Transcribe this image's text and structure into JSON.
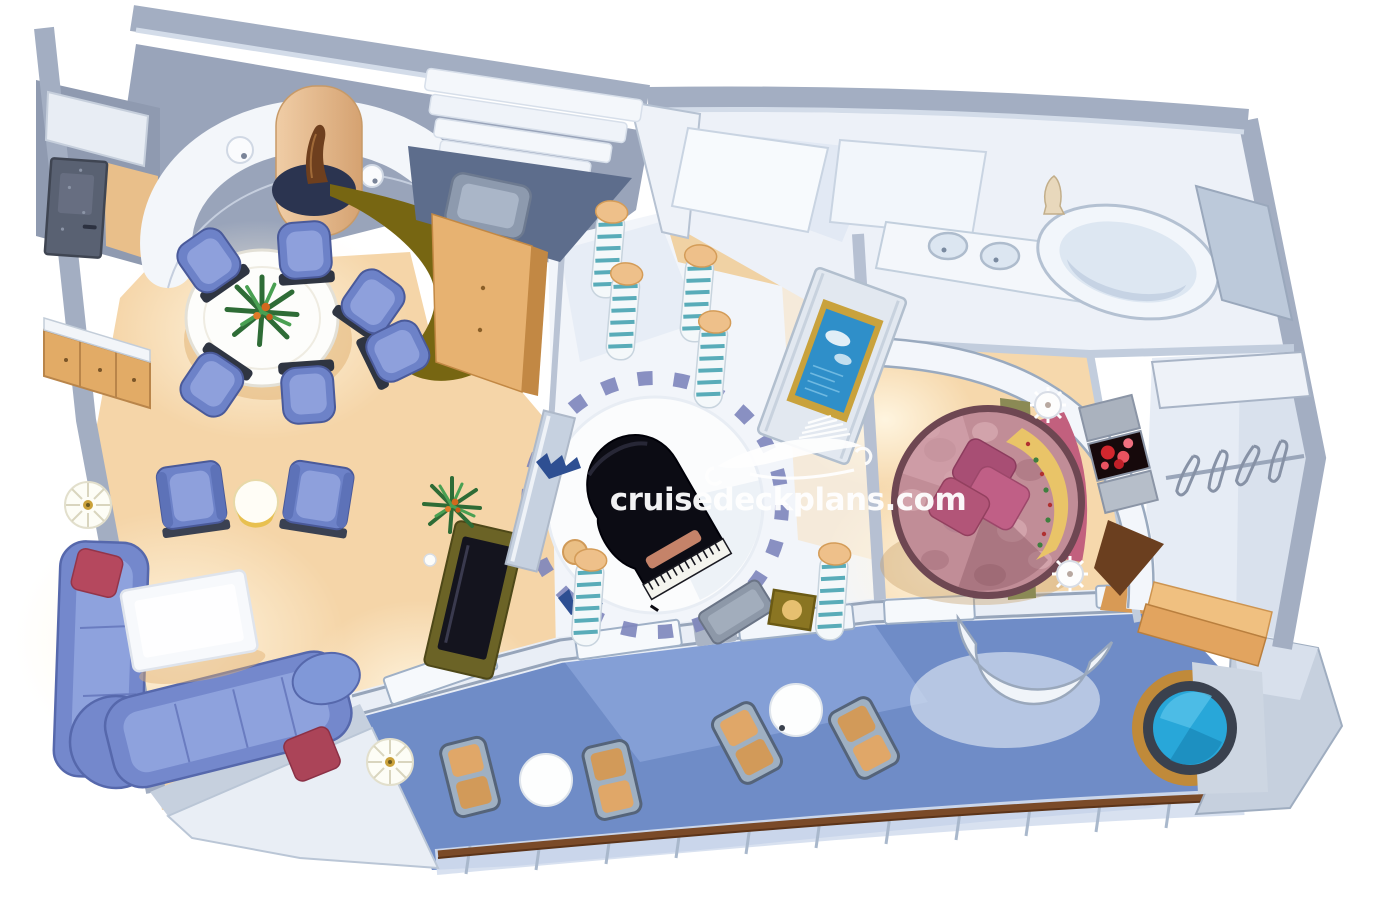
{
  "meta": {
    "kind": "cruise-ship-suite-cutaway-floorplan-rendering",
    "description": "Isometric artist rendering of a luxury cruise ship suite with living room, dining area, grand piano lobby, bedroom with round bed, bathroom, walk-in closet and private balcony with whirlpool"
  },
  "watermark": {
    "text": "cruisedeckplans.com",
    "logo": "cruise-ship-logo"
  },
  "palette": {
    "background": "#ffffff",
    "wall_gray": "#a3aec2",
    "wall_backdrop": "#99a4ba",
    "wall_light": "#d3dce9",
    "floor_peach": "#f5d5a8",
    "floor_glow": "#fff3dd",
    "floor_ice": "#eef2f8",
    "furniture_blue": "#7488cc",
    "furniture_blue_light": "#8ea2dd",
    "cushion_red": "#b5485e",
    "bar_olive": "#776612",
    "wood": "#e2ab66",
    "piano_black": "#0c0c14",
    "platform_ring_blue": "#7d85bb",
    "bed_rose": "#c18d97",
    "bed_rim": "#6e4752",
    "pillow_magenta": "#b25578",
    "headboard_pink": "#c2607e",
    "blanket_gold": "#e9c468",
    "balcony_blue": "#6f8cc7",
    "hottub_cyan": "#28a7d9",
    "hottub_rim": "#3a414e",
    "hottub_surround_tan": "#c08a3a",
    "handrail_brown": "#7a4a28",
    "tv_screen_blue": "#2f8fc9",
    "lounger_tan": "#e0a768",
    "column_stripe_teal": "#3f9fae",
    "watermark_white": "#ffffff"
  },
  "rooms": [
    {
      "name": "entry",
      "items": [
        {
          "item": "entry-door",
          "count": 1
        },
        {
          "item": "sideboard-cabinet",
          "count": 1
        }
      ]
    },
    {
      "name": "dining-area",
      "items": [
        {
          "item": "round-dining-table",
          "count": 1
        },
        {
          "item": "dining-chair",
          "count": 6
        },
        {
          "item": "centerpiece-plant",
          "count": 1
        },
        {
          "item": "curved-bar-counter",
          "count": 1
        },
        {
          "item": "minibar-cabinet",
          "count": 1
        },
        {
          "item": "statue-column",
          "count": 1
        },
        {
          "item": "wall-sconce",
          "count": 2
        }
      ]
    },
    {
      "name": "living-room",
      "items": [
        {
          "item": "l-shaped-sofa",
          "count": 1
        },
        {
          "item": "red-cushion",
          "count": 2
        },
        {
          "item": "coffee-table",
          "count": 1
        },
        {
          "item": "armchair",
          "count": 2
        },
        {
          "item": "side-table",
          "count": 1
        },
        {
          "item": "floor-lamp",
          "count": 2
        },
        {
          "item": "tv-cabinet",
          "count": 1
        },
        {
          "item": "potted-plant",
          "count": 1
        }
      ]
    },
    {
      "name": "piano-lobby",
      "items": [
        {
          "item": "grand-piano",
          "count": 1
        },
        {
          "item": "piano-bench",
          "count": 1
        },
        {
          "item": "circular-platform",
          "count": 1
        },
        {
          "item": "striped-column",
          "count": 6
        },
        {
          "item": "gold-planter",
          "count": 1
        }
      ]
    },
    {
      "name": "bedroom",
      "items": [
        {
          "item": "round-bed",
          "count": 1
        },
        {
          "item": "pillow",
          "count": 3
        },
        {
          "item": "patterned-blanket",
          "count": 1
        },
        {
          "item": "headboard",
          "count": 1
        },
        {
          "item": "nightstand",
          "count": 2
        },
        {
          "item": "flower-artwork",
          "count": 1
        },
        {
          "item": "wall-tv",
          "count": 1
        },
        {
          "item": "wood-bench",
          "count": 1
        }
      ]
    },
    {
      "name": "bathroom",
      "items": [
        {
          "item": "sink",
          "count": 2
        },
        {
          "item": "vanity-counter",
          "count": 1
        },
        {
          "item": "oval-bathtub",
          "count": 1
        },
        {
          "item": "statue",
          "count": 1
        }
      ]
    },
    {
      "name": "walk-in-closet",
      "items": [
        {
          "item": "clothes-rail",
          "count": 1
        },
        {
          "item": "hanger",
          "count": 4
        },
        {
          "item": "wood-step",
          "count": 2
        }
      ]
    },
    {
      "name": "balcony",
      "items": [
        {
          "item": "lounge-chair",
          "count": 4
        },
        {
          "item": "round-table",
          "count": 2
        },
        {
          "item": "whirlpool-hot-tub",
          "count": 1
        },
        {
          "item": "railing",
          "count": 1
        },
        {
          "item": "handrail",
          "count": 1
        },
        {
          "item": "sliding-glass-door",
          "count": 6
        }
      ]
    }
  ]
}
